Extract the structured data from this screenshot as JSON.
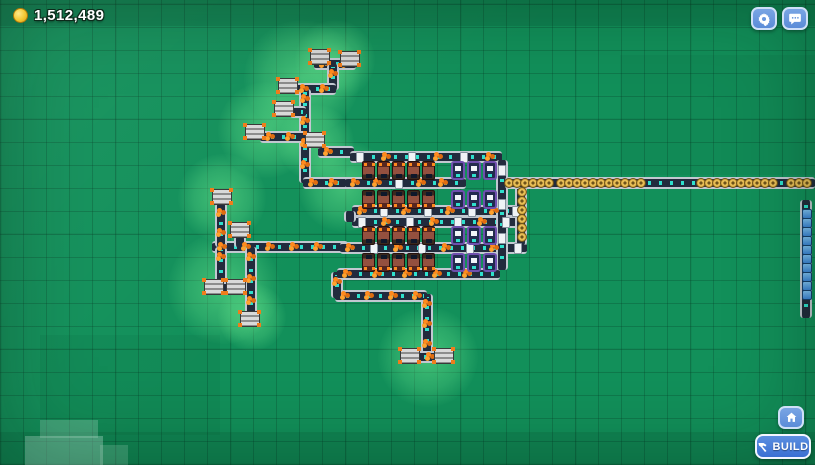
{
  "hud": {
    "money": "1,512,489",
    "coin_icon": "coin",
    "settings_icon": "gear",
    "social_icon": "chat-bubble",
    "home_icon": "home",
    "build_button": {
      "label": "BUILD",
      "icon": "hammer"
    }
  },
  "colors": {
    "grass": "#12905a",
    "belt_body": "#222b3d",
    "belt_edge": "#c2c8d1",
    "belt_dash": "#2fe0cd",
    "ore_item": "#ff8a1e",
    "crate_item": "#f0f3f6",
    "gear_item": "#e7bd55",
    "blue_item": "#4e9ce8",
    "glow": "#76f496",
    "button_blue": "#5b8cd8",
    "build_blue": "#3a6fd2"
  },
  "scene": {
    "patches": [
      {
        "x": 0,
        "y": 0,
        "w": 815,
        "h": 26,
        "c": "rgba(0,30,18,0.12)"
      },
      {
        "x": 0,
        "y": 432,
        "w": 815,
        "h": 33,
        "c": "rgba(0,30,18,0.10)"
      },
      {
        "x": 620,
        "y": 55,
        "w": 195,
        "h": 120,
        "c": "rgba(0,40,25,0.05)"
      },
      {
        "x": 40,
        "y": 335,
        "w": 180,
        "h": 100,
        "c": "rgba(0,40,25,0.05)"
      },
      {
        "x": 40,
        "y": 420,
        "w": 58,
        "h": 18,
        "c": "rgba(190,235,215,0.28)"
      },
      {
        "x": 25,
        "y": 436,
        "w": 78,
        "h": 29,
        "c": "rgba(190,235,215,0.38)"
      },
      {
        "x": 100,
        "y": 445,
        "w": 28,
        "h": 20,
        "c": "rgba(190,235,215,0.22)"
      }
    ],
    "glows": [
      {
        "x": 302,
        "y": 78,
        "r": 58
      },
      {
        "x": 335,
        "y": 60,
        "r": 40
      },
      {
        "x": 266,
        "y": 130,
        "r": 48
      },
      {
        "x": 316,
        "y": 143,
        "r": 38
      },
      {
        "x": 222,
        "y": 198,
        "r": 44
      },
      {
        "x": 224,
        "y": 288,
        "r": 56
      },
      {
        "x": 252,
        "y": 317,
        "r": 34
      },
      {
        "x": 428,
        "y": 357,
        "r": 50
      },
      {
        "x": 344,
        "y": 186,
        "r": 46
      }
    ],
    "belts": [
      {
        "o": "h",
        "y": 64,
        "x": 314,
        "x2": 356,
        "kinds": [
          "ore"
        ],
        "sp": 22
      },
      {
        "o": "v",
        "x": 333,
        "y": 64,
        "y2": 90,
        "kinds": [
          "ore"
        ],
        "sp": 20
      },
      {
        "o": "h",
        "y": 89,
        "x": 294,
        "x2": 336,
        "kinds": [
          "ore"
        ],
        "sp": 20
      },
      {
        "o": "v",
        "x": 305,
        "y": 89,
        "y2": 183,
        "kinds": [
          "ore"
        ],
        "sp": 22
      },
      {
        "o": "h",
        "y": 112,
        "x": 290,
        "x2": 306,
        "kinds": [
          "ore"
        ],
        "sp": 16
      },
      {
        "o": "h",
        "y": 137,
        "x": 260,
        "x2": 306,
        "kinds": [
          "ore"
        ],
        "sp": 20
      },
      {
        "o": "h",
        "y": 152,
        "x": 318,
        "x2": 354,
        "kinds": [
          "ore"
        ],
        "sp": 18
      },
      {
        "o": "h",
        "y": 183,
        "x": 303,
        "x2": 352,
        "kinds": [
          "ore"
        ],
        "sp": 20
      },
      {
        "o": "h",
        "y": 247,
        "x": 212,
        "x2": 348,
        "kinds": [
          "ore"
        ],
        "sp": 24
      },
      {
        "o": "v",
        "x": 221,
        "y": 203,
        "y2": 247,
        "kinds": [
          "ore"
        ],
        "sp": 20
      },
      {
        "o": "v",
        "x": 221,
        "y": 247,
        "y2": 284,
        "kinds": [
          "ore"
        ],
        "sp": 20
      },
      {
        "o": "h",
        "y": 288,
        "x": 207,
        "x2": 247,
        "kinds": [
          "ore"
        ],
        "sp": 16
      },
      {
        "o": "v",
        "x": 240,
        "y": 236,
        "y2": 247
      },
      {
        "o": "v",
        "x": 251,
        "y": 247,
        "y2": 316,
        "kinds": [
          "ore"
        ],
        "sp": 22
      },
      {
        "o": "v",
        "x": 427,
        "y": 294,
        "y2": 353,
        "kinds": [
          "ore"
        ],
        "sp": 20
      },
      {
        "o": "h",
        "y": 296,
        "x": 335,
        "x2": 427,
        "kinds": [
          "ore"
        ],
        "sp": 24
      },
      {
        "o": "v",
        "x": 337,
        "y": 272,
        "y2": 298,
        "kinds": [
          "ore"
        ],
        "sp": 20
      },
      {
        "o": "h",
        "y": 357,
        "x": 402,
        "x2": 452,
        "kinds": [
          "ore"
        ],
        "sp": 18
      },
      {
        "o": "h",
        "y": 157,
        "x": 350,
        "x2": 502,
        "kinds": [
          "crate",
          "ore"
        ],
        "sp": 26
      },
      {
        "o": "h",
        "y": 183,
        "x": 345,
        "x2": 466,
        "kinds": [
          "ore",
          "ore",
          "crate"
        ],
        "sp": 22
      },
      {
        "o": "h",
        "y": 211,
        "x": 352,
        "x2": 527,
        "kinds": [
          "ore",
          "crate"
        ],
        "sp": 22
      },
      {
        "o": "h",
        "y": 222,
        "x": 352,
        "x2": 527,
        "kinds": [
          "crate",
          "ore"
        ],
        "sp": 24
      },
      {
        "o": "v",
        "x": 350,
        "y": 211,
        "y2": 222
      },
      {
        "o": "h",
        "y": 248,
        "x": 340,
        "x2": 527,
        "kinds": [
          "ore",
          "crate"
        ],
        "sp": 24
      },
      {
        "o": "h",
        "y": 274,
        "x": 337,
        "x2": 500,
        "kinds": [
          "ore"
        ],
        "sp": 30
      },
      {
        "o": "v",
        "x": 502,
        "y": 160,
        "y2": 270,
        "kinds": [
          "crate"
        ],
        "sp": 34
      },
      {
        "o": "v",
        "x": 521,
        "y": 186,
        "y2": 245,
        "kind": "gear",
        "clumps": [
          [
            192,
            240
          ]
        ],
        "sp": 9
      },
      {
        "o": "h",
        "y": 183,
        "x": 505,
        "x2": 815,
        "kind": "gear",
        "clumps": [
          [
            508,
            548
          ],
          [
            560,
            640
          ],
          [
            700,
            772
          ],
          [
            790,
            812
          ]
        ],
        "sp": 8
      },
      {
        "o": "v",
        "x": 806,
        "y": 200,
        "y2": 318,
        "kind": "blue",
        "clumps": [
          [
            214,
            302
          ]
        ],
        "sp": 9
      }
    ],
    "extractors": [
      [
        320,
        56
      ],
      [
        350,
        58
      ],
      [
        288,
        85
      ],
      [
        284,
        108
      ],
      [
        255,
        131
      ],
      [
        315,
        139
      ],
      [
        222,
        196
      ],
      [
        240,
        229
      ],
      [
        214,
        286
      ],
      [
        236,
        286
      ],
      [
        250,
        318
      ],
      [
        410,
        355
      ],
      [
        444,
        355
      ]
    ],
    "furnace_xs": [
      362,
      377,
      392,
      407,
      422
    ],
    "furnace_rows": [
      {
        "y": 161,
        "flip": false
      },
      {
        "y": 190,
        "flip": true
      },
      {
        "y": 226,
        "flip": false
      },
      {
        "y": 253,
        "flip": true
      }
    ],
    "workshop_xs": [
      451,
      467,
      483
    ],
    "workshop_rows": [
      {
        "y": 161
      },
      {
        "y": 190
      },
      {
        "y": 226
      },
      {
        "y": 253
      }
    ]
  }
}
